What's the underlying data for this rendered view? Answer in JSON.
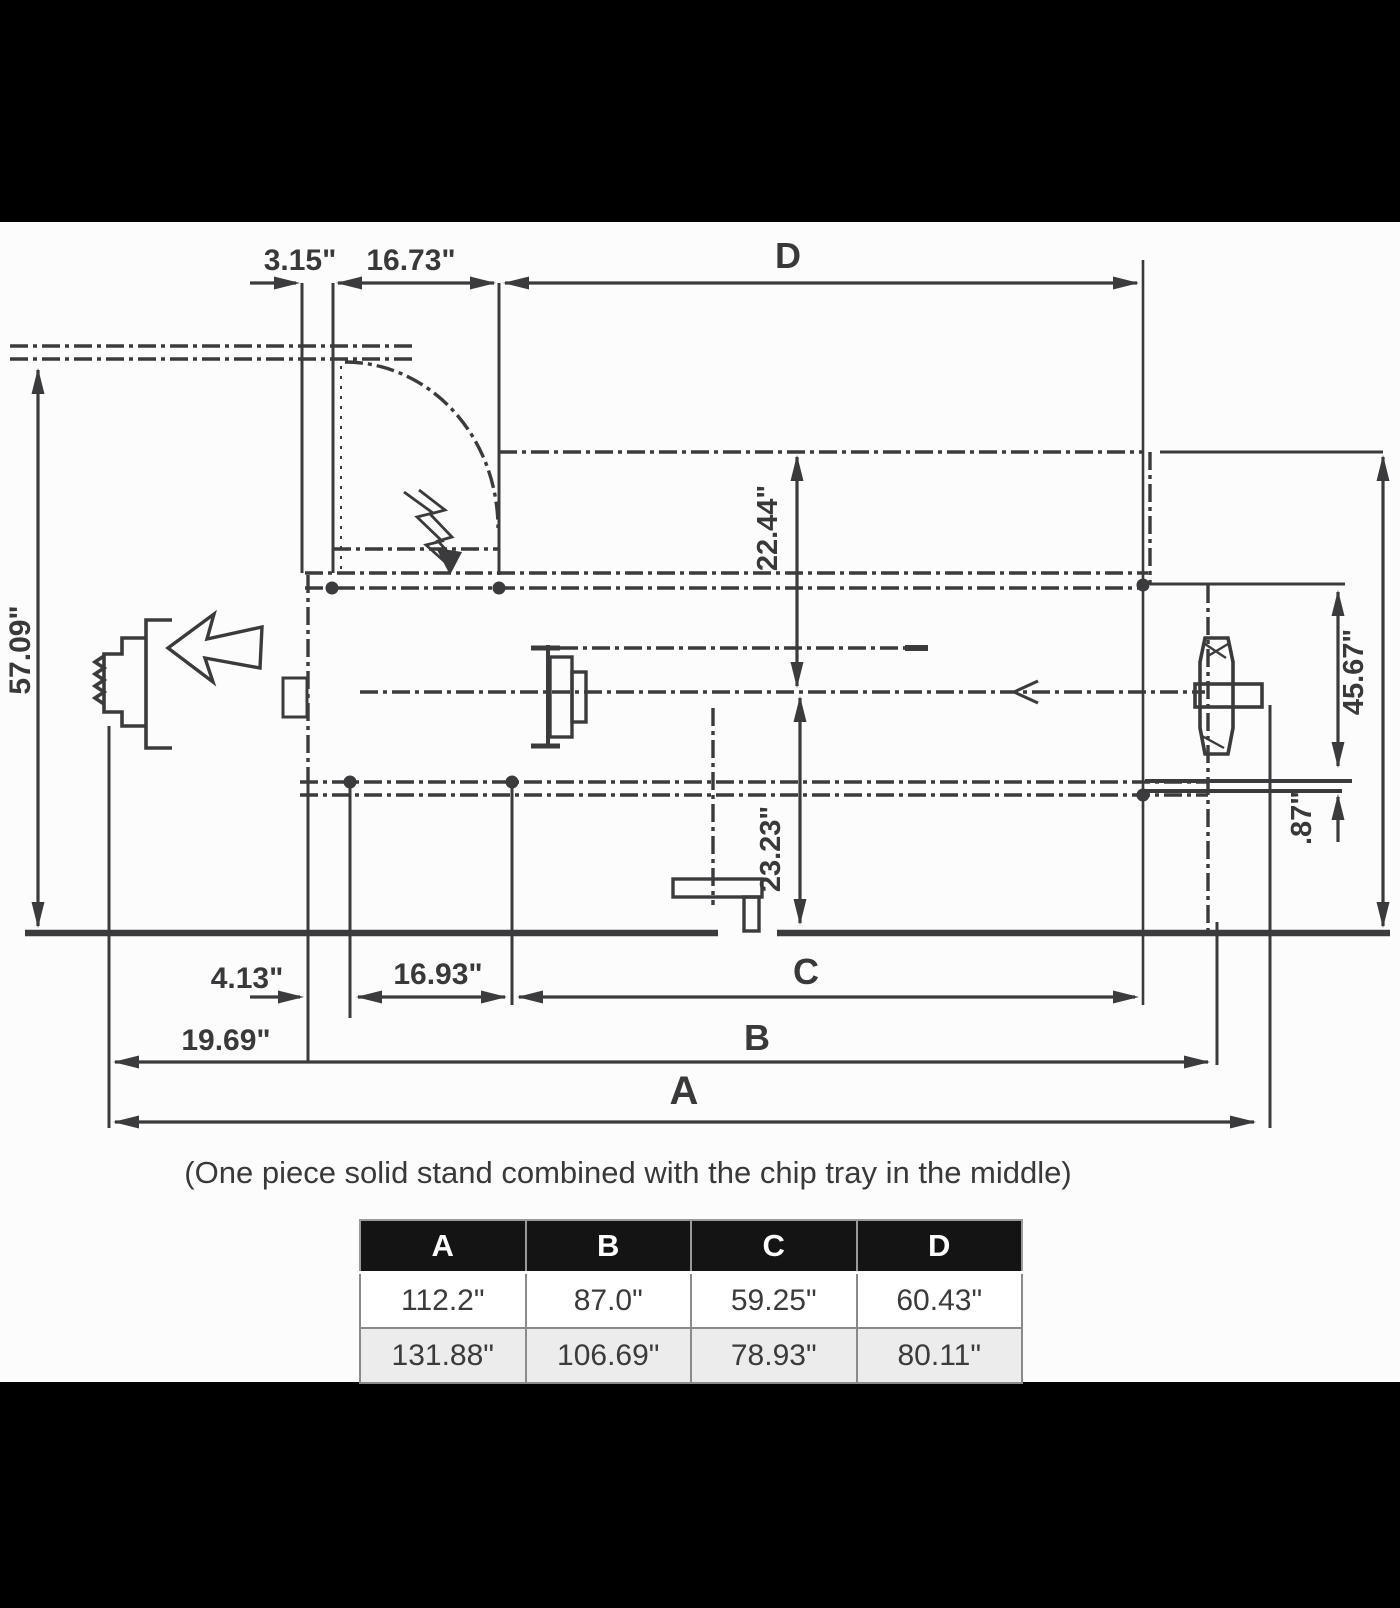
{
  "colors": {
    "ink": "#3b3b3d",
    "paper": "#fcfcfc",
    "bar": "#000000",
    "table_header_bg": "#141414",
    "table_header_text": "#ffffff",
    "table_row_alt_bg": "#ececec"
  },
  "drawing": {
    "caption": "(One piece solid stand combined with the chip tray in the middle)",
    "labels": {
      "top_offset": "3.15\"",
      "door_width": "16.73\"",
      "dim_d": "D",
      "overall_height": "57.09\"",
      "spindle_height": "22.44\"",
      "stand_height": "45.67\"",
      "foot_height": ".87\"",
      "tray_height": "23.23\"",
      "base_offset": "4.13\"",
      "door_front_width": "16.93\"",
      "dim_c": "C",
      "left_section": "19.69\"",
      "dim_b": "B",
      "dim_a": "A"
    }
  },
  "table": {
    "headers": [
      "A",
      "B",
      "C",
      "D"
    ],
    "rows": [
      [
        "112.2\"",
        "87.0\"",
        "59.25\"",
        "60.43\""
      ],
      [
        "131.88\"",
        "106.69\"",
        "78.93\"",
        "80.11\""
      ]
    ]
  }
}
